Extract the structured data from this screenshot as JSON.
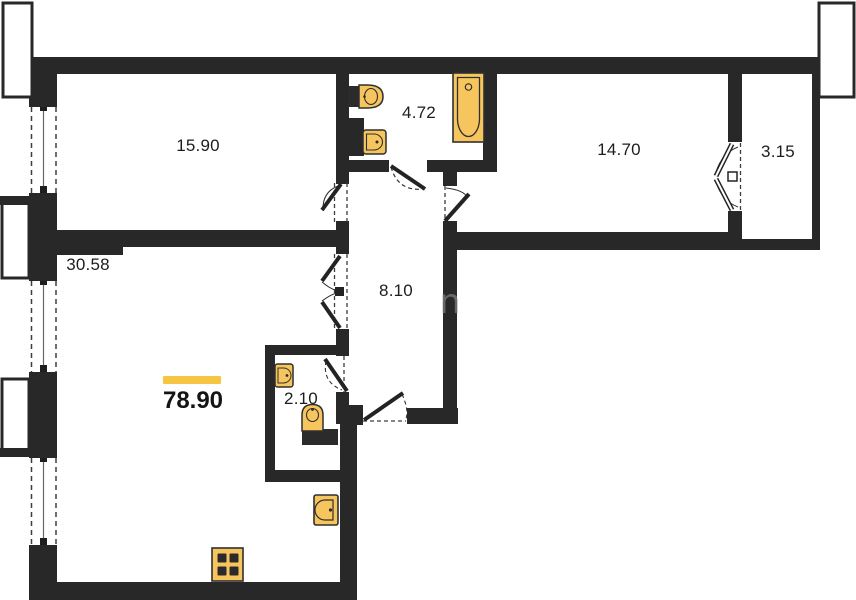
{
  "plan": {
    "title": "apartment-floor-plan",
    "total_area": "78.90",
    "watermark_text": "n",
    "rooms": [
      {
        "name": "living-room",
        "area": "15.90"
      },
      {
        "name": "bathroom",
        "area": "4.72"
      },
      {
        "name": "bedroom",
        "area": "14.70"
      },
      {
        "name": "balcony",
        "area": "3.15"
      },
      {
        "name": "kitchen-living",
        "area": "30.58"
      },
      {
        "name": "hallway",
        "area": "8.10"
      },
      {
        "name": "wc",
        "area": "2.10"
      }
    ],
    "colors": {
      "wall": "#282828",
      "fixture_fill": "#F7C55E",
      "fixture_stroke": "#2f2f2f",
      "highlight": "#F6C544"
    }
  }
}
